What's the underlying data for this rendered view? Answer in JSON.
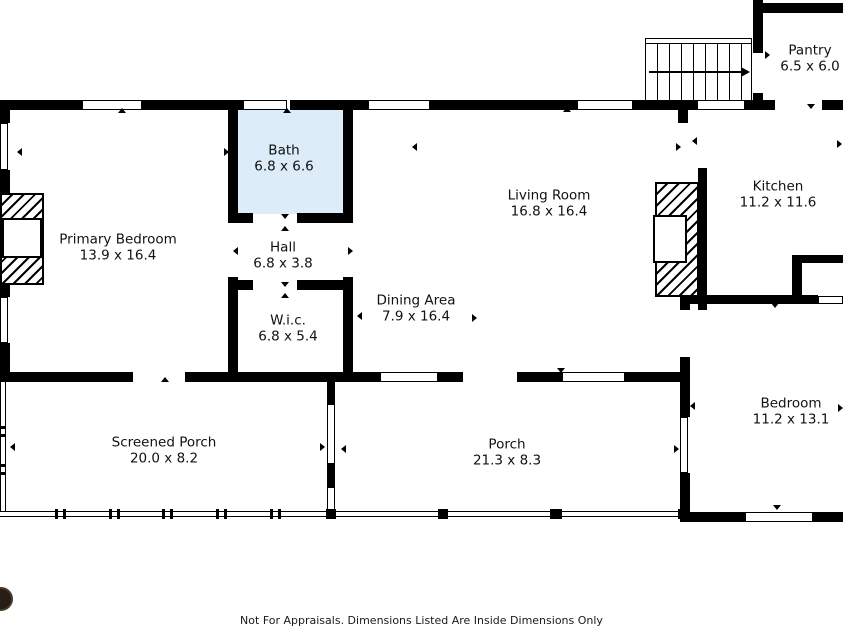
{
  "plan": {
    "rooms": {
      "primary_bedroom": {
        "name": "Primary Bedroom",
        "dims": "13.9 x 16.4"
      },
      "bath": {
        "name": "Bath",
        "dims": "6.8 x 6.6"
      },
      "hall": {
        "name": "Hall",
        "dims": "6.8 x 3.8"
      },
      "wic": {
        "name": "W.i.c.",
        "dims": "6.8 x 5.4"
      },
      "living_room": {
        "name": "Living Room",
        "dims": "16.8 x 16.4"
      },
      "dining_area": {
        "name": "Dining Area",
        "dims": "7.9 x 16.4"
      },
      "kitchen": {
        "name": "Kitchen",
        "dims": "11.2 x 11.6"
      },
      "bedroom": {
        "name": "Bedroom",
        "dims": "11.2 x 13.1"
      },
      "screened_porch": {
        "name": "Screened Porch",
        "dims": "20.0 x 8.2"
      },
      "porch": {
        "name": "Porch",
        "dims": "21.3 x 8.3"
      },
      "pantry": {
        "name": "Pantry",
        "dims": "6.5 x 6.0"
      }
    },
    "footer": {
      "disclaimer": "Not For Appraisals. Dimensions Listed Are Inside Dimensions Only"
    },
    "colors": {
      "bath_fill": "#dcecf8",
      "wall": "#000000",
      "background": "#ffffff"
    }
  }
}
